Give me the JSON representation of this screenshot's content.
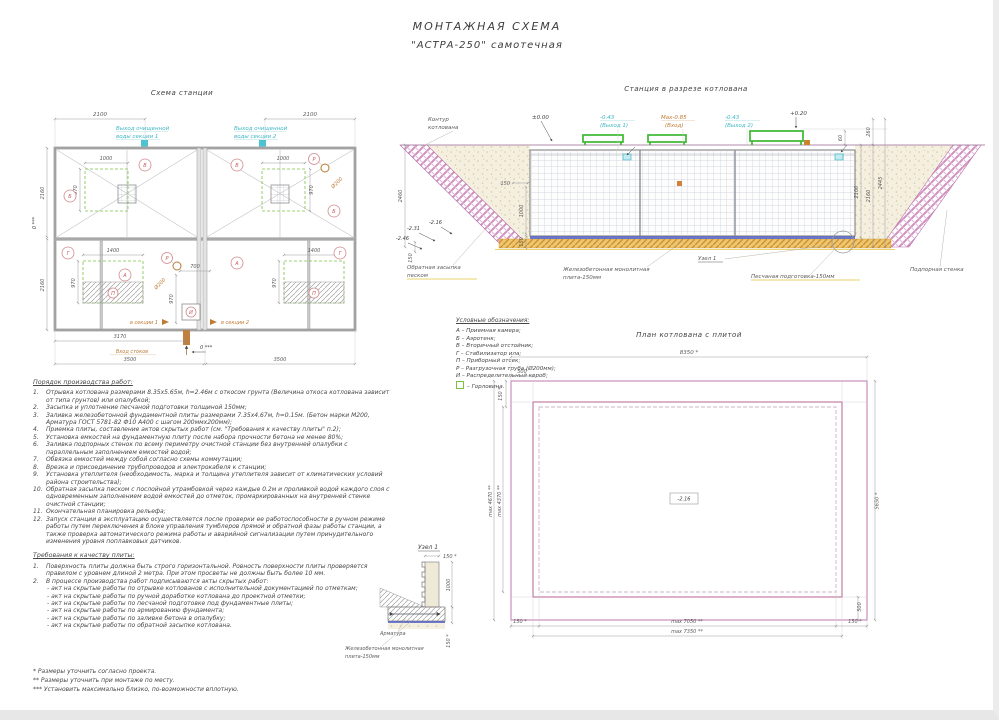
{
  "page": {
    "title_line1": "МОНТАЖНАЯ СХЕМА",
    "title_line2": "\"АСТРА-250\" самотечная"
  },
  "station_plan": {
    "title": "Схема станции",
    "dim_2100": "2100",
    "outlet1_l1": "Выход очищенной",
    "outlet1_l2": "воды секции 1",
    "outlet2_l1": "Выход очищенной",
    "outlet2_l2": "воды секции 2",
    "dim_2160": "2160",
    "zero_mark": "0 ***",
    "dim_1000": "1000",
    "dim_970": "970",
    "dim_1400": "1400",
    "dim_700": "700",
    "dim_3170": "3170",
    "dim_3500": "3500",
    "d200": "Ø200",
    "letter_A": "А",
    "letter_B": "Б",
    "letter_V": "В",
    "letter_G": "Г",
    "letter_P": "П",
    "letter_R": "Р",
    "letter_I": "И",
    "to_section1": "в секции 1",
    "to_section2": "в секции 2",
    "inlet": "Вход стоков"
  },
  "section": {
    "title": "Станция в разрезе котлована",
    "contour_l1": "Контур",
    "contour_l2": "котлована",
    "lvl_zero": "±0.00",
    "out1_lvl": "-0.43",
    "out1_lbl": "(Выход 1)",
    "in_lvl": "Max-0.85",
    "in_lbl": "(Вход)",
    "out2_lvl": "-0.43",
    "out2_lbl": "(Выход 2)",
    "lvl_plus020": "+0.20",
    "dim_60": "60",
    "dim_260": "260",
    "dim_2100": "2100",
    "dim_2160": "2160",
    "dim_2445": "2445",
    "dim_2460": "2460",
    "dim_150": "150",
    "dim_1000": "1000",
    "lvl_216": "-2.16",
    "lvl_231": "-2.31",
    "lvl_246": "-2.46",
    "backfill_l1": "Обратная засыпка",
    "backfill_l2": "песком",
    "slab_l1": "Железобетонная монолитная",
    "slab_l2": "плита-150мм",
    "node_ref": "Узел 1",
    "sand_prep": "Песчаная подготовка-150мм",
    "retaining_wall": "Подпорная стенка"
  },
  "legend": {
    "title": "Условные обозначения:",
    "items": [
      "А – Приемная камера;",
      "Б – Аэротенк;",
      "В – Вторичный отстойник;",
      "Г – Стабилизатор ила;",
      "П – Приборный отсек;",
      "Р – Разгрузочная труба (Ø200мм);",
      "И – Распределительный короб;"
    ],
    "manhole_label": "– Горловина."
  },
  "pit_plan": {
    "title": "План котлована с плитой",
    "dim_8350": "8350 *",
    "dim_500": "500",
    "dim_150": "150 *",
    "dim_4670": "max 4670 **",
    "dim_4370": "max 4370 **",
    "dim_5650": "5650 *",
    "dim_7050": "max 7050 **",
    "dim_7350": "max 7350 **",
    "lvl_216": "-2.16"
  },
  "node1": {
    "title": "Узел 1",
    "dim_150": "150 *",
    "dim_1000": "1000",
    "rebar": "Арматура",
    "slab_l1": "Железобетонная монолитная",
    "slab_l2": "плита-150мм"
  },
  "work_order": {
    "title": "Порядок производства работ:",
    "items": [
      {
        "n": "1.",
        "t": "Отрывка котлована размерами 8.35х5.65м, h=2.46м с откосом грунта (Величина откоса котлована зависит от типа грунтов) или опалубкой;"
      },
      {
        "n": "2.",
        "t": "Засыпка и уплотнение песчаной подготовки толщиной 150мм;"
      },
      {
        "n": "3.",
        "t": "Заливка железобетонной фундаментной плиты размерами 7.35х4.67м, h=0.15м. (Бетон марки М200, Арматура ГОСТ 5781-82 Ф10 А400 с шагом 200ммх200мм);"
      },
      {
        "n": "4.",
        "t": "Приемка плиты, составление актов скрытых работ (см. \"Требования к качеству плиты\" п.2);"
      },
      {
        "n": "5.",
        "t": "Установка емкостей на фундаментную плиту после набора прочности бетона не менее 80%;"
      },
      {
        "n": "6.",
        "t": "Заливка подпорных стенок по всему периметру очистной станции без внутренней опалубки с параллельным заполнением емкостей водой;"
      },
      {
        "n": "7.",
        "t": "Обвязка емкостей между собой согласно схемы коммутации;"
      },
      {
        "n": "8.",
        "t": "Врезка и присоединение трубопроводов и электрокабеля к станции;"
      },
      {
        "n": "9.",
        "t": "Установка утеплителя (необходимость, марка и толщина утеплителя зависит от климатических условий района строительства);"
      },
      {
        "n": "10.",
        "t": "Обратная засыпка песком с послойной утрамбовкой через каждые 0.2м и проливкой водой каждого слоя с одновременным заполнением водой емкостей до отметок, промаркированных на внутренней стенке очистной станции;"
      },
      {
        "n": "11.",
        "t": "Окончательная планировка рельефа;"
      },
      {
        "n": "12.",
        "t": "Запуск станции в эксплуатацию осуществляется после проверки ее работоспособности в ручном режиме работы путем переключения в блоке управления тумблеров прямой и обратной фазы работы станции, а также проверка автоматического режима работы и аварийной сигнализации путем принудительного изменения уровня поплавковых датчиков."
      }
    ]
  },
  "quality": {
    "title": "Требования к качеству плиты:",
    "item1_n": "1.",
    "item1": "Поверхность плиты должна быть строго горизонтальной. Ровность поверхности плиты проверяется правилом с уровнем длиной 2 метра. При этом просветы не должны быть более 10 мм.",
    "item2_n": "2.",
    "item2": "В процессе производства работ подписываются акты скрытых работ:",
    "acts": [
      "- акт на скрытые работы по отрывке котлованов с исполнительной документацией по отметкам;",
      "- акт на скрытые работы по ручной доработке котлована до проектной отметки;",
      "- акт на скрытые работы по песчаной подготовке под фундаментные плиты;",
      "- акт на скрытые работы по армированию фундамента;",
      "- акт на скрытые работы по заливке бетона в опалубку;",
      "- акт на скрытые работы по обратной засыпке котлована."
    ]
  },
  "footnotes": [
    "*  Размеры уточнить согласно проекта.",
    "** Размеры уточнить при монтаже по месту.",
    "*** Установить максимально близко, по-возможности вплотную."
  ],
  "colors": {
    "cyan": "#3fb6c4",
    "orange": "#bf7a33",
    "red_letter": "#c4595c",
    "green": "#3cb832",
    "pink_hatch": "#cf8fc0",
    "sand": "#f4efdf",
    "sand_prep_orange": "#eec66f",
    "plate_blue": "#5560c0",
    "pit_outline_pink": "#ca8ebc"
  }
}
